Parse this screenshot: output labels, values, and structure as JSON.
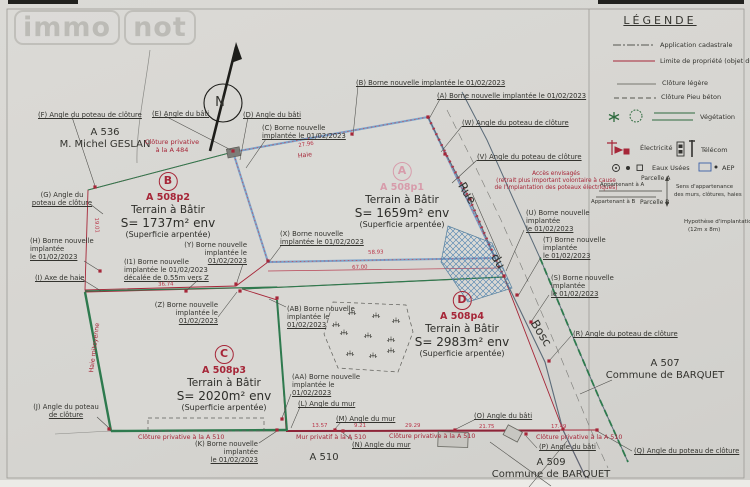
{
  "watermark": {
    "part1": "immo",
    "part2": "not"
  },
  "compass": {
    "label": "N"
  },
  "legend": {
    "title": "LÉGENDE",
    "items": [
      {
        "icon": "dashdot-line",
        "label": "Application cadastrale",
        "x": 660,
        "y": 42
      },
      {
        "icon": "red-line",
        "label": "Limite de propriété (objet du",
        "x": 660,
        "y": 58
      },
      {
        "icon": "thin-line",
        "label": "Clôture légère",
        "x": 662,
        "y": 80
      },
      {
        "icon": "dashed-line",
        "label": "Clôture Pieu béton",
        "x": 661,
        "y": 94
      },
      {
        "icon": "vegetation-icons",
        "label": "Végétation",
        "x": 700,
        "y": 114
      },
      {
        "icon": "electricity-icon",
        "label": "Électricité",
        "x": 640,
        "y": 145
      },
      {
        "icon": "telecom-icon",
        "label": "Télécom",
        "x": 701,
        "y": 147
      },
      {
        "icon": "sewer-icons",
        "label": "Eaux Usées",
        "x": 652,
        "y": 165
      },
      {
        "icon": "aep-icon",
        "label": "AEP",
        "x": 722,
        "y": 165
      }
    ],
    "ownership": [
      {
        "label": "Parcelle A",
        "x": 641,
        "y": 175,
        "s": 6
      },
      {
        "label": "Appartenant à A",
        "x": 600,
        "y": 182,
        "s": 5.4
      },
      {
        "label": "Appartenant à B",
        "x": 591,
        "y": 199,
        "s": 5.4
      },
      {
        "label": "Parcelle B",
        "x": 640,
        "y": 199,
        "s": 6
      },
      {
        "label": "Sens d'appartenance",
        "x": 676,
        "y": 184,
        "s": 5.4
      },
      {
        "label": "des murs, clôtures, haies",
        "x": 674,
        "y": 192,
        "s": 5.4
      }
    ],
    "hypothesis": [
      {
        "label": "Hypothèse d'implantation",
        "x": 684,
        "y": 219,
        "s": 5.5
      },
      {
        "label": "(12m x 8m)",
        "x": 688,
        "y": 227,
        "s": 5.5
      }
    ]
  },
  "parcels": [
    {
      "letter": "B",
      "ref": "A 508p2",
      "title": "Terrain à Bâtir",
      "area": "S= 1737m² env",
      "note": "(Superficie arpentée)",
      "cx": 168,
      "top": 172,
      "accent": "red"
    },
    {
      "letter": "A",
      "ref": "A 508p1",
      "title": "Terrain à Bâtir",
      "area": "S= 1659m² env",
      "note": "(Superficie arpentée)",
      "cx": 402,
      "top": 162,
      "accent": "pink"
    },
    {
      "letter": "C",
      "ref": "A 508p3",
      "title": "Terrain à Bâtir",
      "area": "S= 2020m² env",
      "note": "(Superficie arpentée)",
      "cx": 224,
      "top": 345,
      "accent": "red"
    },
    {
      "letter": "D",
      "ref": "A 508p4",
      "title": "Terrain à Bâtir",
      "area": "S= 2983m² env",
      "note": "(Superficie arpentée)",
      "cx": 462,
      "top": 291,
      "accent": "red"
    }
  ],
  "plan": {
    "labels": [
      {
        "n": "north-label",
        "lines": [
          "N"
        ],
        "x": 220,
        "y": 95,
        "a": "c",
        "s": 13
      },
      {
        "n": "callout-f",
        "lines": [
          "(F) Angle du poteau de clôture"
        ],
        "x": 38,
        "y": 111,
        "u": 1
      },
      {
        "n": "neighbor-a536",
        "lines": [
          "A 536",
          "M. Michel GESLAN"
        ],
        "x": 105,
        "y": 127,
        "a": "c",
        "s": 10
      },
      {
        "n": "callout-e",
        "lines": [
          "(E) Angle du bâti"
        ],
        "x": 152,
        "y": 110,
        "u": 1
      },
      {
        "n": "callout-d",
        "lines": [
          "(D) Angle du bâti"
        ],
        "x": 243,
        "y": 111,
        "u": 1
      },
      {
        "n": "callout-c",
        "lines": [
          "(C) Borne nouvelle",
          "implantée le 01/02/2023"
        ],
        "x": 262,
        "y": 124,
        "u": 1
      },
      {
        "n": "callout-b-borne",
        "lines": [
          "(B) Borne nouvelle implantée le 01/02/2023"
        ],
        "x": 356,
        "y": 79,
        "u": 1
      },
      {
        "n": "callout-a-borne",
        "lines": [
          "(A) Borne nouvelle implantée le 01/02/2023"
        ],
        "x": 437,
        "y": 92,
        "u": 1
      },
      {
        "n": "callout-w",
        "lines": [
          "(W) Angle du  poteau de clôture"
        ],
        "x": 462,
        "y": 119,
        "u": 1
      },
      {
        "n": "callout-v",
        "lines": [
          "(V) Angle du  poteau de clôture"
        ],
        "x": 477,
        "y": 153,
        "u": 1
      },
      {
        "n": "note-cloture-a484",
        "lines": [
          "Clôture privative",
          "à la A 484"
        ],
        "x": 172,
        "y": 139,
        "a": "c",
        "c": "red",
        "s": 6.5
      },
      {
        "n": "callout-g",
        "lines": [
          "(G) Angle du",
          "poteau de clôture"
        ],
        "x": 62,
        "y": 191,
        "a": "c",
        "u": 1
      },
      {
        "n": "callout-h",
        "lines": [
          "(H) Borne nouvelle",
          "implantée",
          "le 01/02/2023"
        ],
        "x": 30,
        "y": 237,
        "u": 1
      },
      {
        "n": "callout-i",
        "lines": [
          "(I) Axe de haie"
        ],
        "x": 35,
        "y": 274,
        "u": 1
      },
      {
        "n": "callout-i1",
        "lines": [
          "(I1) Borne nouvelle",
          "implantée le 01/02/2023",
          "décalée de 0.55m vers Z"
        ],
        "x": 124,
        "y": 258,
        "u": 1
      },
      {
        "n": "callout-y",
        "lines": [
          "(Y) Borne nouvelle",
          "implantée le",
          "01/02/2023"
        ],
        "x": 247,
        "y": 241,
        "a": "r",
        "u": 1
      },
      {
        "n": "callout-z",
        "lines": [
          "(Z) Borne nouvelle",
          "implantée le",
          "01/02/2023"
        ],
        "x": 218,
        "y": 301,
        "a": "r",
        "u": 1
      },
      {
        "n": "callout-x",
        "lines": [
          "(X) Borne nouvelle",
          "implantée le 01/02/2023"
        ],
        "x": 280,
        "y": 230,
        "u": 1
      },
      {
        "n": "note-acces",
        "lines": [
          "Accès envisagés",
          "(retrait plus important volontaire à cause",
          "de l'implantation des poteaux électriques)"
        ],
        "x": 556,
        "y": 171,
        "a": "c",
        "c": "red",
        "s": 5.8
      },
      {
        "n": "callout-u",
        "lines": [
          "(U) Borne nouvelle",
          "implantée",
          "le 01/02/2023"
        ],
        "x": 526,
        "y": 209,
        "u": 1
      },
      {
        "n": "callout-t",
        "lines": [
          "(T) Borne nouvelle",
          "implantée",
          "le 01/02/2023"
        ],
        "x": 543,
        "y": 236,
        "u": 1
      },
      {
        "n": "callout-s",
        "lines": [
          "(S) Borne nouvelle",
          "implantée",
          "le 01/02/2023"
        ],
        "x": 551,
        "y": 274,
        "u": 1
      },
      {
        "n": "callout-r",
        "lines": [
          "(R) Angle du  poteau de clôture"
        ],
        "x": 573,
        "y": 330,
        "u": 1
      },
      {
        "n": "neighbor-a507",
        "lines": [
          "A 507",
          "Commune de BARQUET"
        ],
        "x": 665,
        "y": 358,
        "a": "c",
        "s": 10
      },
      {
        "n": "callout-ab",
        "lines": [
          "(AB) Borne nouvelle",
          "implantée le",
          "01/02/2023"
        ],
        "x": 287,
        "y": 305,
        "u": 1
      },
      {
        "n": "callout-aa",
        "lines": [
          "(AA) Borne nouvelle",
          "implantée le",
          "01/02/2023"
        ],
        "x": 292,
        "y": 373,
        "u": 1
      },
      {
        "n": "callout-l",
        "lines": [
          "(L) Angle du mur"
        ],
        "x": 298,
        "y": 400,
        "u": 1
      },
      {
        "n": "callout-m",
        "lines": [
          "(M) Angle du mur"
        ],
        "x": 336,
        "y": 415,
        "u": 1
      },
      {
        "n": "callout-n",
        "lines": [
          "(N) Angle du mur"
        ],
        "x": 352,
        "y": 441,
        "u": 1
      },
      {
        "n": "note-mur-privatif",
        "lines": [
          "Mur privatif à la A 510"
        ],
        "x": 296,
        "y": 434,
        "c": "red",
        "s": 6.3
      },
      {
        "n": "note-cloture-mid",
        "lines": [
          "Clôture privative à la A 510"
        ],
        "x": 389,
        "y": 433,
        "c": "red",
        "s": 6.3
      },
      {
        "n": "callout-o",
        "lines": [
          "(O) Angle du bâti"
        ],
        "x": 474,
        "y": 412,
        "u": 1
      },
      {
        "n": "note-cloture-right",
        "lines": [
          "Clôture privative à la A 510"
        ],
        "x": 536,
        "y": 434,
        "c": "red",
        "s": 6.3
      },
      {
        "n": "callout-p",
        "lines": [
          "(P) Angle du bâti"
        ],
        "x": 539,
        "y": 443,
        "u": 1
      },
      {
        "n": "callout-q",
        "lines": [
          "(Q) Angle du  poteau de clôture"
        ],
        "x": 634,
        "y": 447,
        "u": 1
      },
      {
        "n": "neighbor-a509",
        "lines": [
          "A 509",
          "Commune de BARQUET"
        ],
        "x": 551,
        "y": 457,
        "a": "c",
        "s": 10
      },
      {
        "n": "label-a510",
        "lines": [
          "A 510"
        ],
        "x": 324,
        "y": 452,
        "a": "c",
        "s": 10
      },
      {
        "n": "callout-j",
        "lines": [
          "(J) Angle du poteau",
          "de clôture"
        ],
        "x": 66,
        "y": 403,
        "a": "c",
        "u": 1
      },
      {
        "n": "callout-k",
        "lines": [
          "(K) Borne nouvelle",
          "implantée",
          "le 01/02/2023"
        ],
        "x": 258,
        "y": 440,
        "a": "r",
        "u": 1
      },
      {
        "n": "note-cloture-left",
        "lines": [
          "Clôture privative à la A 510"
        ],
        "x": 138,
        "y": 434,
        "c": "red",
        "s": 6.3
      },
      {
        "n": "street-name-rue",
        "lines": [
          "Rue"
        ],
        "x": 467,
        "y": 186,
        "a": "c",
        "s": 12,
        "r": 58
      },
      {
        "n": "street-name-du",
        "lines": [
          "du"
        ],
        "x": 498,
        "y": 254,
        "a": "c",
        "s": 12,
        "r": 58
      },
      {
        "n": "street-name-bosc",
        "lines": [
          "Bosc"
        ],
        "x": 541,
        "y": 326,
        "a": "c",
        "s": 12,
        "r": 58
      },
      {
        "n": "note-haie",
        "lines": [
          "Haie"
        ],
        "x": 305,
        "y": 152,
        "a": "c",
        "c": "red",
        "s": 6.3,
        "r": -7
      },
      {
        "n": "note-haie-mitoyenne",
        "lines": [
          "Haie mitoyenne"
        ],
        "x": 95,
        "y": 344,
        "a": "c",
        "c": "red",
        "s": 6.3,
        "r": -83
      },
      {
        "n": "dimension-label",
        "lines": [
          "36.74"
        ],
        "x": 158,
        "y": 282,
        "c": "dim",
        "r": -2
      },
      {
        "n": "dimension-label",
        "lines": [
          "58.93"
        ],
        "x": 368,
        "y": 250,
        "c": "dim",
        "r": -2
      },
      {
        "n": "dimension-label",
        "lines": [
          "67.00"
        ],
        "x": 352,
        "y": 265,
        "c": "dim",
        "r": -2
      },
      {
        "n": "dimension-label",
        "lines": [
          "27.96"
        ],
        "x": 298,
        "y": 143,
        "c": "dim",
        "r": -9
      },
      {
        "n": "dimension-label",
        "lines": [
          "19.01"
        ],
        "x": 96,
        "y": 222,
        "a": "c",
        "c": "dim",
        "r": 87
      },
      {
        "n": "dimension-label",
        "lines": [
          "13.57"
        ],
        "x": 312,
        "y": 423,
        "c": "dim"
      },
      {
        "n": "dimension-label",
        "lines": [
          "9.21"
        ],
        "x": 354,
        "y": 423,
        "c": "dim"
      },
      {
        "n": "dimension-label",
        "lines": [
          "29.29"
        ],
        "x": 405,
        "y": 423,
        "c": "dim"
      },
      {
        "n": "dimension-label",
        "lines": [
          "21.75"
        ],
        "x": 479,
        "y": 424,
        "c": "dim"
      },
      {
        "n": "dimension-label",
        "lines": [
          "17.49"
        ],
        "x": 551,
        "y": 424,
        "c": "dim"
      }
    ],
    "bornes": [
      [
        95,
        187
      ],
      [
        233,
        151
      ],
      [
        352,
        134
      ],
      [
        428,
        117
      ],
      [
        268,
        261
      ],
      [
        236,
        284
      ],
      [
        240,
        291
      ],
      [
        186,
        291
      ],
      [
        100,
        271
      ],
      [
        504,
        276
      ],
      [
        517,
        295
      ],
      [
        531,
        322
      ],
      [
        549,
        361
      ],
      [
        277,
        298
      ],
      [
        282,
        419
      ],
      [
        277,
        430
      ],
      [
        335,
        430
      ],
      [
        343,
        431
      ],
      [
        455,
        430
      ],
      [
        526,
        434
      ],
      [
        597,
        430
      ],
      [
        470,
        199
      ],
      [
        445,
        154
      ],
      [
        109,
        429
      ],
      [
        563,
        429
      ]
    ],
    "veg": [
      [
        352,
        314
      ],
      [
        376,
        317
      ],
      [
        396,
        322
      ],
      [
        344,
        334
      ],
      [
        368,
        337
      ],
      [
        391,
        341
      ],
      [
        350,
        355
      ],
      [
        373,
        357
      ],
      [
        391,
        352
      ],
      [
        336,
        326
      ]
    ]
  }
}
